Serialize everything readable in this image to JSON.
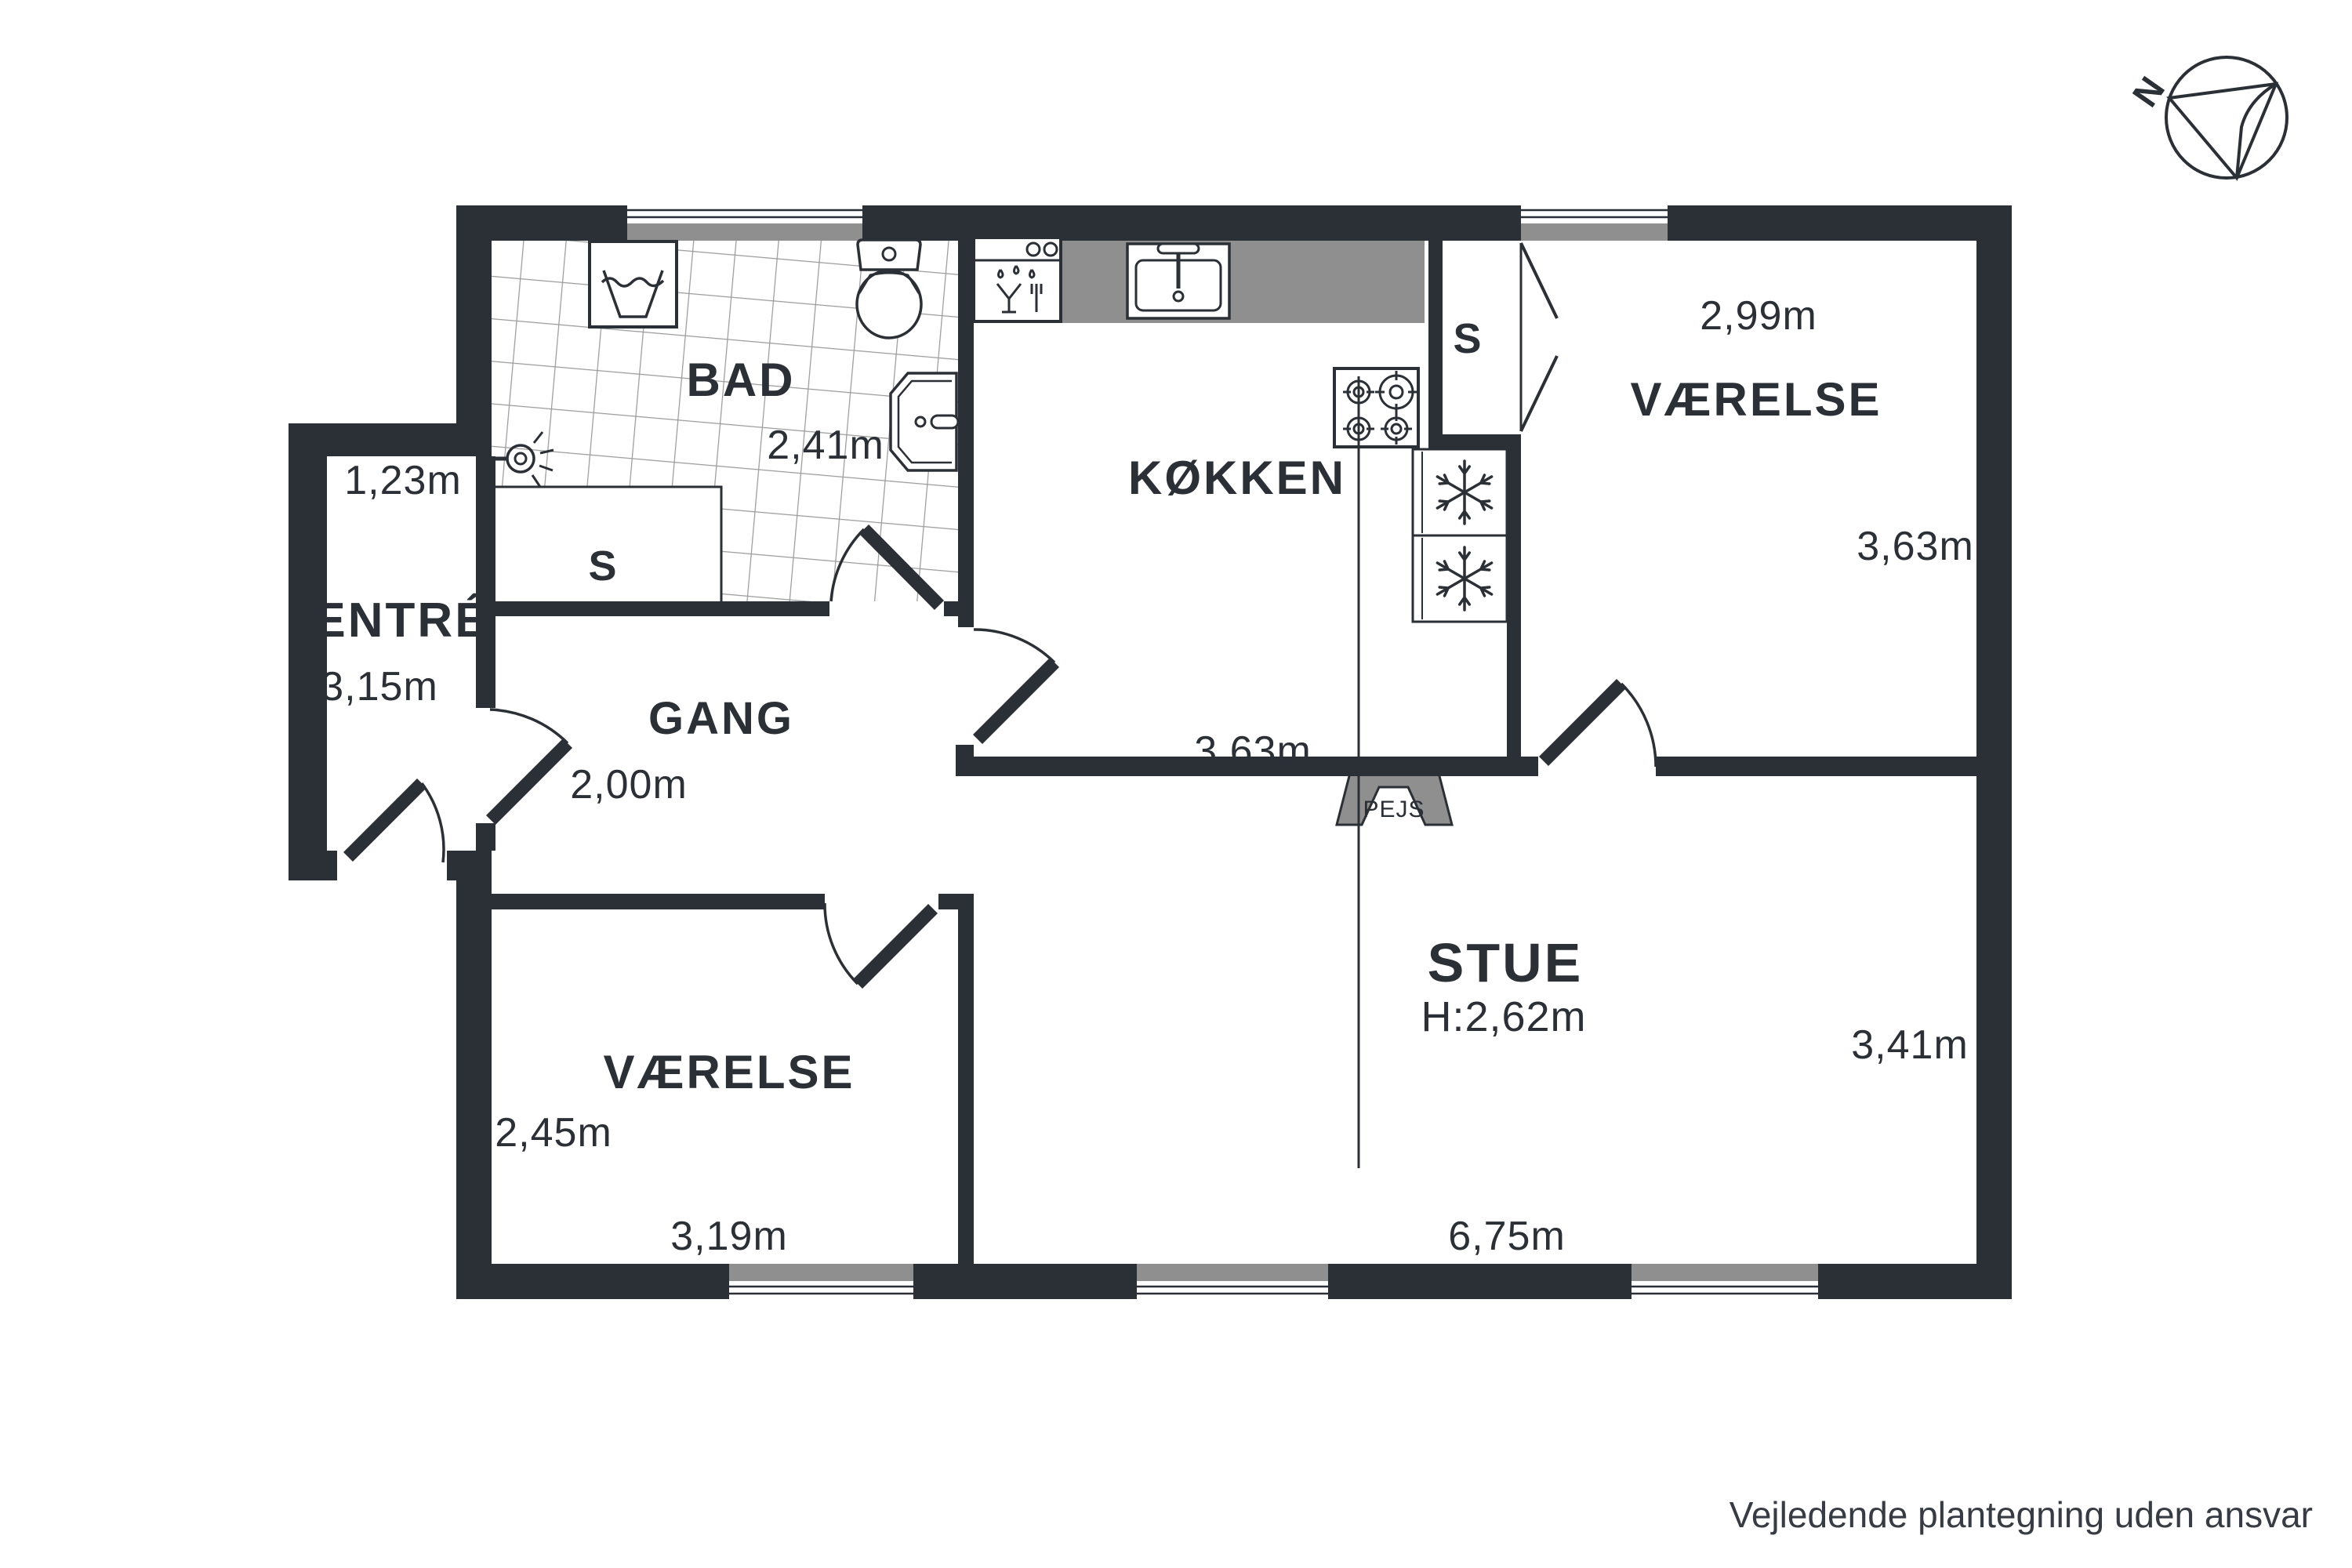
{
  "page": {
    "disclaimer": "Vejledende plantegning uden ansvar"
  },
  "colors": {
    "wall": "#2b2f36",
    "gray_fill": "#8f8f8f",
    "tile_line": "#9b9b9b",
    "text": "#2b2f36"
  },
  "compass": {
    "label": "N"
  },
  "rooms": {
    "bad": {
      "name": "BAD",
      "width": "2,41m"
    },
    "entre": {
      "name": "ENTRÉ",
      "width": "1,23m",
      "height": "3,15m"
    },
    "gang": {
      "name": "GANG",
      "width": "2,00m"
    },
    "koekken": {
      "name": "KØKKEN",
      "width": "3,63m"
    },
    "vaerelse_ne": {
      "name": "VÆRELSE",
      "width": "2,99m",
      "height": "3,63m"
    },
    "vaerelse_sw": {
      "name": "VÆRELSE",
      "height": "2,45m",
      "width": "3,19m"
    },
    "stue": {
      "name": "STUE",
      "ceiling_height": "H:2,62m",
      "height": "3,41m",
      "width": "6,75m"
    }
  },
  "closets": {
    "bad_closet": "S",
    "vaerelse_closet": "S"
  },
  "fireplace": {
    "label": "PEJS"
  },
  "icons": {
    "washing_machine": "washing-machine-icon",
    "toilet": "toilet-icon",
    "shower": "shower-icon",
    "bath_sink": "bath-sink-icon",
    "dishwasher": "dishwasher-icon",
    "kitchen_sink": "kitchen-sink-icon",
    "stove": "stove-icon",
    "freezer_top": "snowflake-icon",
    "freezer_bottom": "snowflake-icon",
    "north_arrow": "north-compass-icon"
  }
}
